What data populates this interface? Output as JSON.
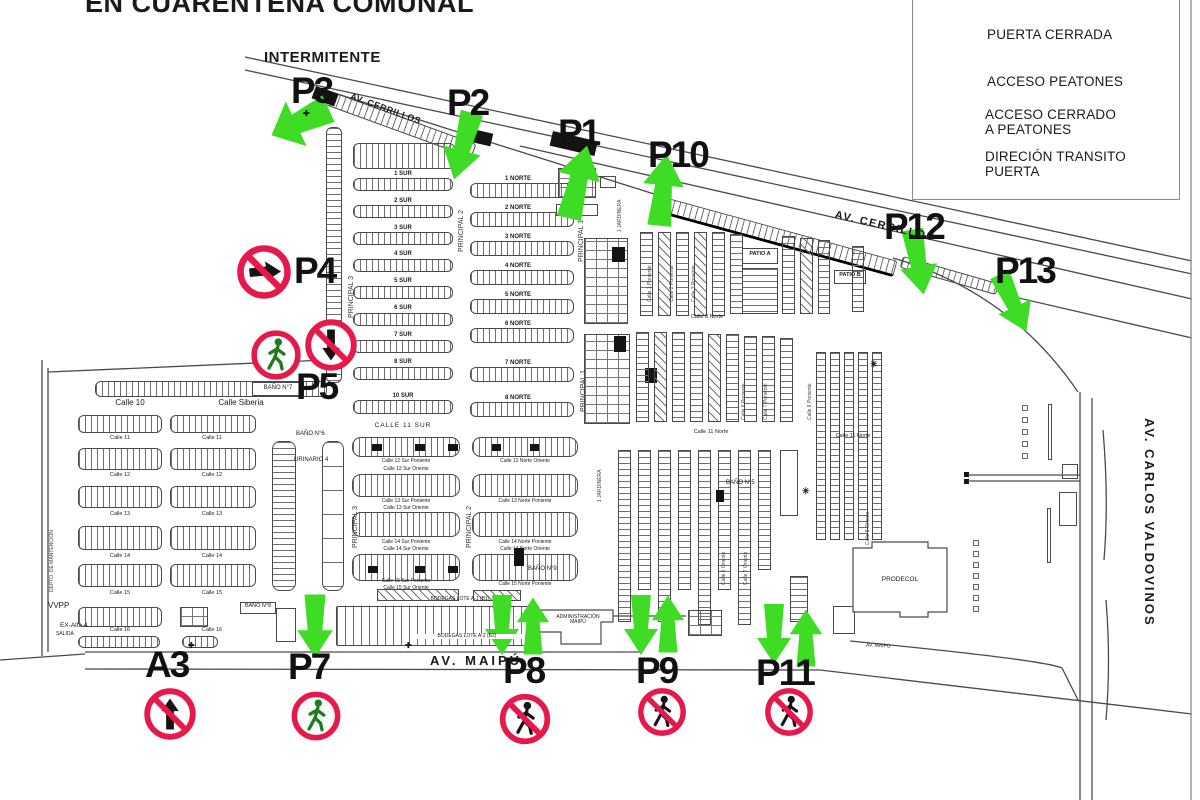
{
  "colors": {
    "arrow_green": "#3EDC25",
    "prohibition_red": "#E6194B",
    "pedestrian_green": "#1E7C1E",
    "ink": "#1A1A1A"
  },
  "title": "EN CUARENTENA COMUNAL",
  "legend": {
    "title": "SIMBOLOGÍA",
    "items": [
      {
        "icon": "closed-gate-icon",
        "label": "PUERTA CERRADA"
      },
      {
        "icon": "pedestrian-access-icon",
        "label": "ACCESO PEATONES"
      },
      {
        "icon": "no-pedestrian-access-icon",
        "label": "ACCESO CERRADO\nA PEATONES"
      },
      {
        "icon": "gate-direction-arrow-icon",
        "label": "DIRECIÓN TRANSITO\nPUERTA"
      }
    ]
  },
  "gates": {
    "p1": "P1",
    "p2": "P2",
    "p3": "P3",
    "p4": "P4",
    "p5": "P5",
    "p7": "P7",
    "p8": "P8",
    "p9": "P9",
    "p10": "P10",
    "p11": "P11",
    "p12": "P12",
    "p13": "P13",
    "a3": "A3"
  },
  "notes": {
    "intermittent": "INTERMITENTE"
  },
  "streets": {
    "av_cerrillos_a": "AV. CERRILLOS",
    "av_cerrillos_b": "AV. CERRILLOS",
    "av_maipu": "AV. MAIPÚ",
    "av_maipu_small": "AV. MAIPÚ",
    "av_carlos_valdovinos": "AV. CARLOS VALDOVINOS",
    "principal_1": "PRINCIPAL 1",
    "principal_2": "PRINCIPAL 2",
    "principal_3": "PRINCIPAL 3",
    "jardinera": "1 JARDINERA"
  },
  "blocks": {
    "calle_10": "Calle 10",
    "calle_siberia": "Calle Siberia",
    "left_calles": [
      "Calle 11",
      "Calle 12",
      "Calle 13",
      "Calle 14",
      "Calle 15",
      "Calle 16"
    ],
    "sur_rows": [
      "1 SUR",
      "2 SUR",
      "3 SUR",
      "4 SUR",
      "5 SUR",
      "6 SUR",
      "7 SUR",
      "8 SUR",
      "10 SUR"
    ],
    "norte_rows": [
      "1 NORTE",
      "2 NORTE",
      "3 NORTE",
      "4 NORTE",
      "5 NORTE",
      "6 NORTE",
      "7 NORTE",
      "8 NORTE"
    ],
    "calle_11_sur": "CALLE 11 SUR",
    "calle_11_norte": "Calle 11 Norte",
    "calle_8_norte": "Calle 8 Norte",
    "sur_wide": [
      "Calle 12 Sur Poniente",
      "Calle 12 Sur Oriente",
      "Calle 13 Sur Poniente",
      "Calle 13 Sur Oriente",
      "Calle 14 Sur Poniente",
      "Calle 14 Sur Oriente",
      "Calle 15 Sur Poniente",
      "Calle 15 Sur Oriente"
    ],
    "norte_wide": [
      "Calle 12 Norte Oriente",
      "Calle 13 Norte Poniente",
      "Calle 14 Norte Poniente",
      "Calle 14 Norte Oriente",
      "Calle 15 Norte Poniente"
    ],
    "vert_calles_pon": [
      "Calle 1 Poniente",
      "Calle 2 Poniente",
      "Calle 3 Poniente",
      "Calle 6 Poniente",
      "Calle 7 Poniente",
      "Calle 8 Poniente"
    ],
    "vert_calles_ori": [
      "Calle 6 Oriente",
      "Calle 7 Oriente",
      "Calle 8 Oriente"
    ],
    "patio_a": "PATIO A",
    "patio_b": "PATIO B"
  },
  "facilities": {
    "bano5": "BAÑO N°5",
    "bano6": "BAÑO N°6",
    "bano7": "BAÑO N°7",
    "bano8": "BAÑO N°8",
    "bano9": "BAÑO N°9",
    "urinario": "URINARIO 4",
    "prodecol": "PRODECOL",
    "admin": "ADMINISTRACIÓN MAIPÚ",
    "bodega_a1": "BODEGAS LOTE A-1 (B1)",
    "bodega_a2": "BODEGAS LOTE A-2 (B2)",
    "vvpp": "VVPP",
    "ex_alfa": "EX-Alfa 4",
    "salida": "SALIDA",
    "depto": "DEPTO. DE MANTENCIÓN"
  }
}
